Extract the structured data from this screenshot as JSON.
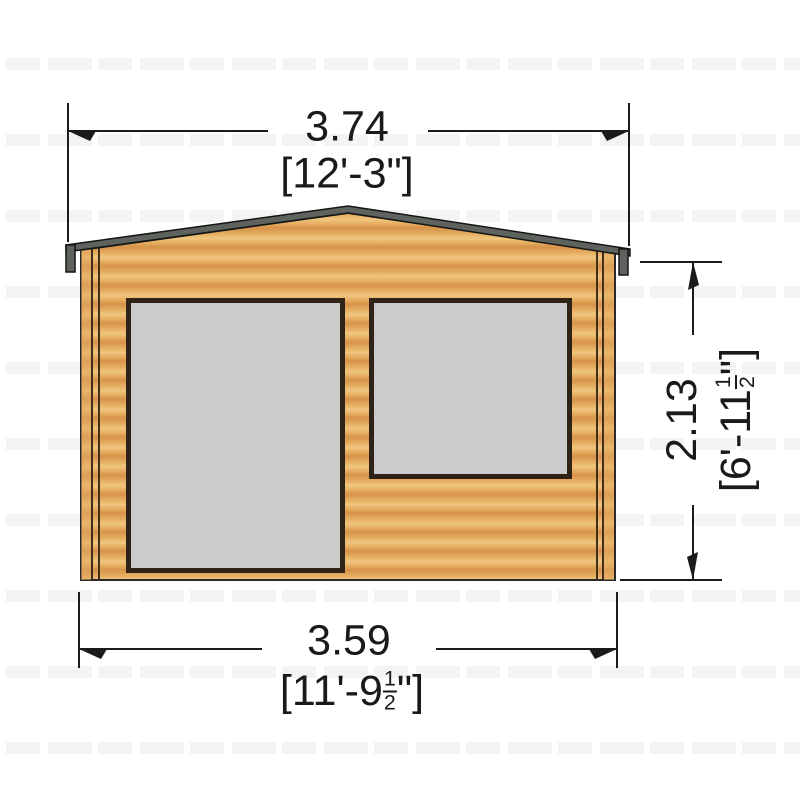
{
  "drawing": {
    "subject": "log-cabin-front-elevation",
    "labels": {
      "top_width": {
        "metric": "3.74",
        "imperial": "[12'-3\"]"
      },
      "bottom_width": {
        "metric": "3.59",
        "imperial_prefix": "[11'-9",
        "fraction_numerator": "1",
        "fraction_denominator": "2",
        "imperial_suffix": "\"]"
      },
      "side_height": {
        "metric": "2.13",
        "imperial_prefix": "[6'-11",
        "fraction_numerator": "1",
        "fraction_denominator": "2",
        "imperial_suffix": "\"]"
      }
    },
    "colors": {
      "wood_light": "#f0c57e",
      "wood_mid": "#e5ad60",
      "wood_dark": "#d6934a",
      "corner_log": "#e2a95e",
      "window_pane": "#cbcbcb",
      "window_frame": "#2e2316",
      "roof_fascia": "#5f635d",
      "line": "#1b1b1b"
    }
  }
}
